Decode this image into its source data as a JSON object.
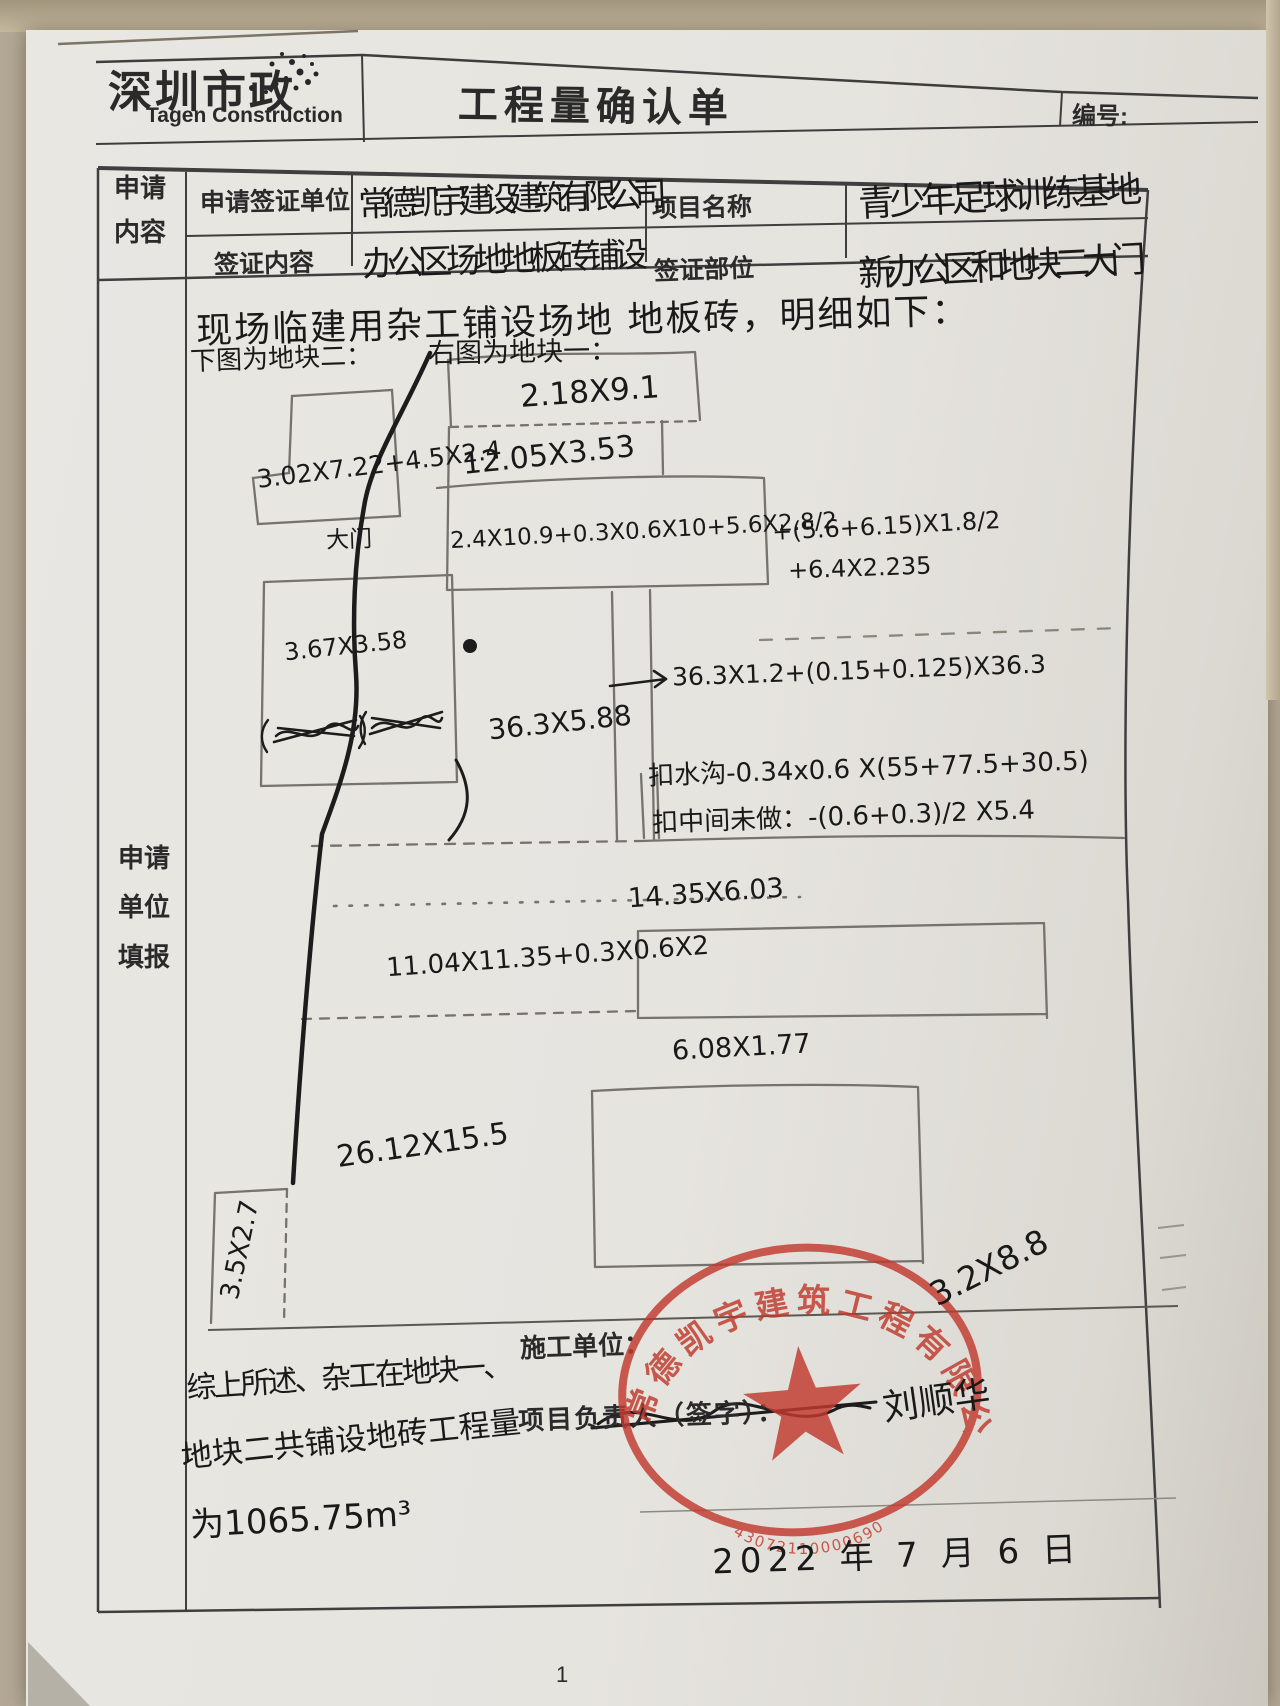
{
  "header": {
    "logo_cn": "深圳市政",
    "logo_en": "Tagen Construction",
    "title": "工程量确认单",
    "doc_no_label": "编号:"
  },
  "form": {
    "left_label": "申请内容",
    "row1_label": "申请签证单位",
    "row1_value": "常德凯宇建设建筑有限公司",
    "row1_label2": "项目名称",
    "row1_value2": "青少年足球训练基地",
    "row2_label": "签证内容",
    "row2_value": "办公区场地地板砖铺设",
    "row2_label2": "签证部位",
    "row2_value2": "新办公区和地块二大门"
  },
  "main": {
    "left_label": "申请单位填报",
    "intro": "现场临建用杂工铺设场地 地板砖，明细如下：",
    "note_left": "下图为地块二：",
    "note_right": "右图为地块一："
  },
  "diagram": {
    "labels": [
      {
        "text": "2.18X9.1"
      },
      {
        "text": "12.05X3.53"
      },
      {
        "text": "3.02X7.22+4.5X2.4"
      },
      {
        "text": "大门"
      },
      {
        "text": "2.4X10.9+0.3X0.6X10+5.6X2.8/2"
      },
      {
        "text": "+(5.6+6.15)X1.8/2"
      },
      {
        "text": "+6.4X2.235"
      },
      {
        "text": "3.67X3.58"
      },
      {
        "text": "36.3X5.88"
      },
      {
        "text": "36.3X1.2+(0.15+0.125)X36.3"
      },
      {
        "text": "扣水沟-0.34x0.6 X(55+77.5+30.5)"
      },
      {
        "text": "扣中间未做：-(0.6+0.3)/2 X5.4"
      },
      {
        "text": "14.35X6.03"
      },
      {
        "text": "11.04X11.35+0.3X0.6X2"
      },
      {
        "text": "6.08X1.77"
      },
      {
        "text": "26.12X15.5"
      },
      {
        "text": "3.5X2.7"
      }
    ]
  },
  "summary": {
    "line1": "综上所述、杂工在地块一、",
    "line2": "地块二共铺设地砖工程量",
    "line3": "为1065.75m³"
  },
  "footer": {
    "contractor_label": "施工单位：",
    "manager_label": "项目负责人（签字）：",
    "signature": "刘顺华",
    "date": "2022 年 7 月 6 日",
    "page_number": "1",
    "stamp": {
      "company": "常德凯宇建筑工程有限公司",
      "code": "43072110000690",
      "overlay_note": "3.2X8.8"
    }
  }
}
